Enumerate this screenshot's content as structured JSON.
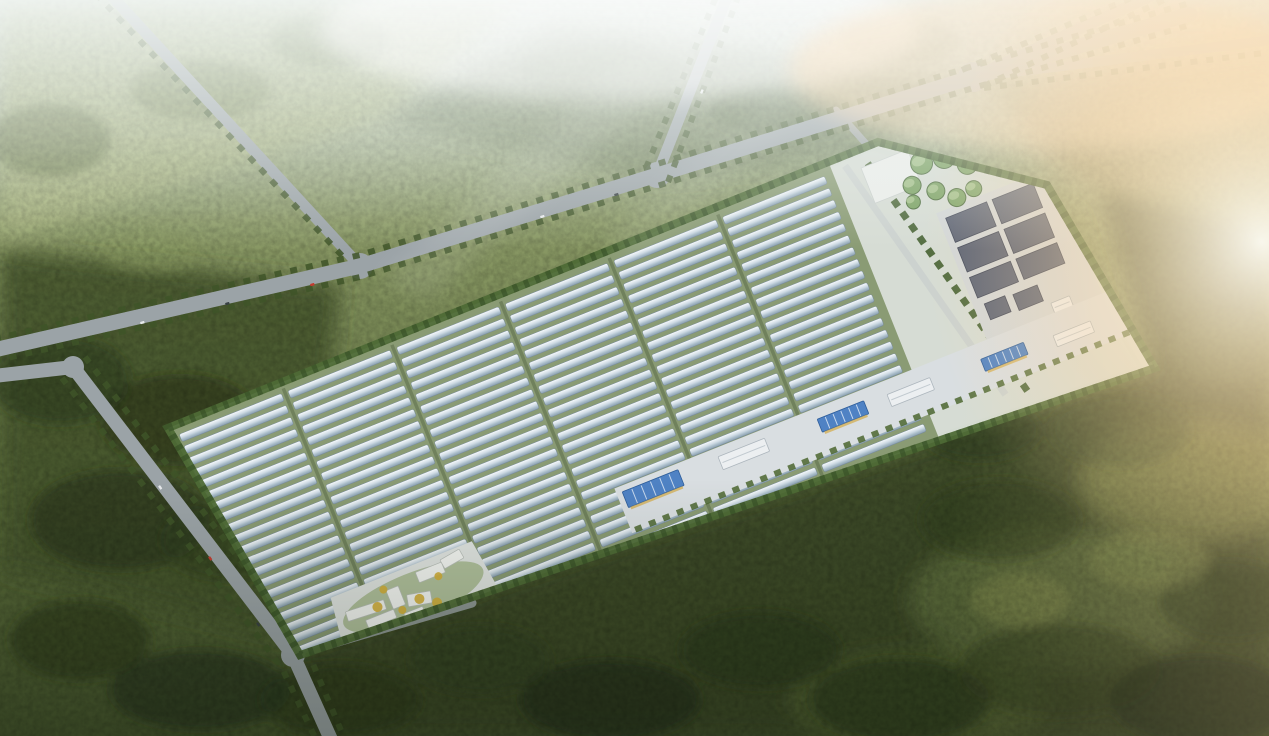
{
  "scene": {
    "type": "aerial-architectural-rendering",
    "subject": "greenhouse-campus-with-tank-farm-and-solar-yard",
    "palette": {
      "road": "#9ba3a7",
      "roadInner": "#ccd2cf",
      "hedge": "#4e6a36",
      "compoundBase": "#d6dcd4",
      "fieldBase": "#8a9b74",
      "greenhouseHigh": "#f6f9fb",
      "greenhouseLow": "#8da1b1",
      "panel": "#5c6476",
      "tank": "#7ba263",
      "roofBlue": "#4f82c4",
      "roofPale": "#eceff1",
      "buildingWhite": "#f3f5f2",
      "accent": "#d4af39",
      "forestDark": "#2d3a1e",
      "forestMid": "#45552f",
      "meadow": "#a8b47e",
      "mist": "#f3f7f5",
      "sun": "#ffeccb"
    },
    "roads": {
      "lines": [
        {
          "name": "main-avenue",
          "pts": [
            [
              -6,
              350
            ],
            [
              360,
              266
            ],
            [
              657,
              175
            ],
            [
              973,
              77
            ],
            [
              1190,
              14
            ]
          ],
          "w": 15,
          "o": 1
        },
        {
          "name": "north-branch-west",
          "pts": [
            [
              657,
              175
            ],
            [
              729,
              -8
            ]
          ],
          "w": 11,
          "o": 1
        },
        {
          "name": "north-branch-east",
          "pts": [
            [
              973,
              77
            ],
            [
              1160,
              -8
            ]
          ],
          "w": 11,
          "o": 1
        },
        {
          "name": "east-branch",
          "pts": [
            [
              973,
              77
            ],
            [
              1272,
              40
            ]
          ],
          "w": 10,
          "o": 0.9
        },
        {
          "name": "northwest-branch",
          "pts": [
            [
              108,
              -8
            ],
            [
              360,
              266
            ]
          ],
          "w": 11,
          "o": 1
        },
        {
          "name": "west-boundary",
          "pts": [
            [
              -6,
              376
            ],
            [
              73,
              367
            ],
            [
              293,
              655
            ],
            [
              333,
              744
            ]
          ],
          "w": 14,
          "o": 1
        },
        {
          "name": "south-spur",
          "pts": [
            [
              293,
              655
            ],
            [
              472,
              603
            ]
          ],
          "w": 9,
          "o": 0.85
        },
        {
          "name": "entry-spur",
          "pts": [
            [
              836,
              110
            ],
            [
              876,
              155
            ]
          ],
          "w": 7,
          "o": 0.9
        }
      ],
      "intersections": [
        [
          360,
          266,
          13
        ],
        [
          657,
          175,
          13
        ],
        [
          973,
          77,
          15
        ],
        [
          73,
          367,
          11
        ],
        [
          293,
          655,
          12
        ]
      ]
    },
    "compound": {
      "outline": "168,428 878,142 1047,185 1155,368 300,655",
      "rotation_deg": -21.8,
      "greenhouse_blocks": {
        "count": 6,
        "rows_per_block": 22,
        "block_width": 110,
        "block_gap": 7,
        "row_pitch": 12.7,
        "row_height": 8,
        "origin": [
          8,
          10
        ]
      },
      "tanks": [
        [
          798,
          34,
          11
        ],
        [
          821,
          37,
          11
        ],
        [
          840,
          52,
          10
        ],
        [
          781,
          51,
          9
        ],
        [
          801,
          65,
          9
        ],
        [
          818,
          79,
          9
        ],
        [
          837,
          77,
          8
        ],
        [
          776,
          67,
          7
        ]
      ],
      "panel_slabs": [
        [
          800,
          94,
          44,
          26
        ],
        [
          850,
          94,
          44,
          26
        ],
        [
          800,
          126,
          44,
          26
        ],
        [
          850,
          126,
          44,
          26
        ],
        [
          800,
          158,
          44,
          22
        ],
        [
          850,
          158,
          44,
          22
        ],
        [
          804,
          188,
          22,
          17
        ],
        [
          834,
          190,
          26,
          17
        ]
      ],
      "se_buildings": [
        [
          398,
          228,
          60,
          17,
          "blue"
        ],
        [
          500,
          231,
          50,
          14,
          "pale"
        ],
        [
          606,
          233,
          50,
          14,
          "blue"
        ],
        [
          680,
          236,
          46,
          13,
          "pale"
        ],
        [
          780,
          238,
          46,
          13,
          "blue"
        ],
        [
          856,
          243,
          40,
          12,
          "pale"
        ]
      ],
      "ne_buildings": [
        [
          866,
          212,
          20,
          11,
          "pale"
        ],
        [
          878,
          227,
          48,
          12,
          "pale"
        ],
        [
          890,
          243,
          44,
          12,
          "pale"
        ]
      ],
      "admin_buildings": [
        [
          96,
          238,
          40,
          10,
          4
        ],
        [
          112,
          252,
          30,
          9,
          0
        ],
        [
          142,
          232,
          13,
          20,
          0
        ],
        [
          158,
          246,
          24,
          12,
          12
        ],
        [
          176,
          226,
          28,
          11,
          0
        ],
        [
          204,
          222,
          22,
          10,
          -8
        ],
        [
          150,
          260,
          20,
          8,
          0
        ]
      ],
      "yellow_trees": [
        [
          128,
          244,
          5
        ],
        [
          150,
          256,
          4
        ],
        [
          170,
          252,
          5
        ],
        [
          196,
          238,
          4
        ],
        [
          140,
          230,
          4
        ],
        [
          185,
          262,
          5
        ]
      ]
    },
    "cars": [
      [
        140,
        322,
        -16,
        "#e8eaec"
      ],
      [
        225,
        303,
        -16,
        "#384043"
      ],
      [
        310,
        284,
        -16,
        "#c33b2f"
      ],
      [
        540,
        216,
        -17,
        "#e8eaec"
      ],
      [
        614,
        194,
        -17,
        "#384043"
      ],
      [
        700,
        93,
        -68,
        "#e8eaec"
      ],
      [
        160,
        485,
        55,
        "#e8eaec"
      ],
      [
        210,
        556,
        55,
        "#c33b2f"
      ],
      [
        258,
        622,
        55,
        "#384043"
      ]
    ]
  }
}
